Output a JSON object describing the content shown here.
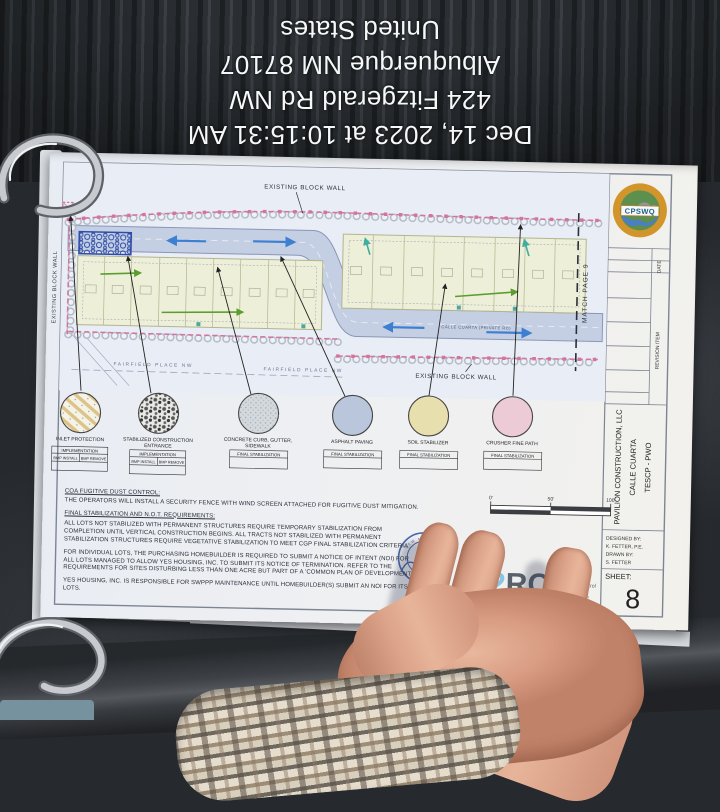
{
  "overlay": {
    "line1": "Dec 14, 2023 at 10:15:31 AM",
    "line2": "424 Fitzgerald Rd NW",
    "line3": "Albuquerque NM 87107",
    "line4": "United States"
  },
  "plan": {
    "wall_label_top": "EXISTING BLOCK WALL",
    "wall_label_bottom": "EXISTING BLOCK WALL",
    "wall_label_left": "EXISTING BLOCK WALL",
    "match_label": "MATCH PAGE 9",
    "street_label_1": "FAIRFIELD PLACE NW",
    "street_label_2": "FAIRFIELD PLACE NW",
    "road_label": "CALLE CUARTA (PRIVATE RD)"
  },
  "legend": {
    "items": [
      {
        "lines": [
          "INLET PROTECTION"
        ],
        "header": "IMPLEMENTATION",
        "col1": "BMP INSTALL",
        "col2": "BMP REMOVE"
      },
      {
        "lines": [
          "STABILIZED CONSTRUCTION",
          "ENTRANCE"
        ],
        "header": "IMPLEMENTATION",
        "col1": "BMP INSTALL",
        "col2": "BMP REMOVE"
      },
      {
        "lines": [
          "CONCRETE CURB, GUTTER,",
          "SIDEWALK"
        ],
        "header": "FINAL STABILIZATION"
      },
      {
        "lines": [
          "ASPHALT PAVING"
        ],
        "header": "FINAL STABILIZATION"
      },
      {
        "lines": [
          "SOIL STABILIZER"
        ],
        "header": "FINAL STABILIZATION"
      },
      {
        "lines": [
          "CRUSHER FINE PATH"
        ],
        "header": "FINAL STABILIZATION"
      }
    ]
  },
  "notes": {
    "h1": "COA FUGITIVE DUST CONTROL:",
    "p1": "THE OPERATORS WILL INSTALL A SECURITY FENCE WITH WIND SCREEN ATTACHED FOR FUGITIVE DUST MITIGATION.",
    "h2": "FINAL STABILIZATION AND N.O.T. REQUIREMENTS:",
    "p2": "ALL LOTS NOT STABILIZED WITH PERMANENT STRUCTURES REQUIRE TEMPORARY STABILIZATION FROM COMPLETION UNTIL VERTICAL CONSTRUCTION BEGINS. ALL TRACTS NOT STABILIZED WITH PERMANENT STABILIZATION STRUCTURES REQUIRE VEGETATIVE STABILIZATION TO MEET CGP FINAL STABILIZATION CRITERIA.",
    "p3": "FOR INDIVIDUAL LOTS, THE PURCHASING HOMEBUILDER IS REQUIRED TO SUBMIT A NOTICE OF INTENT (NOI) FOR ALL LOTS MANAGED TO ALLOW YES HOUSING, INC. TO SUBMIT ITS NOTICE OF TERMINATION. REFER TO THE REQUIREMENTS FOR SITES DISTURBING LESS THAN ONE ACRE BUT PART OF A 'COMMON PLAN OF DEVELOPMENT'.",
    "p4": "YES HOUSING, INC. IS RESPONSIBLE FOR SWPPP MAINTENANCE UNTIL HOMEBUILDER(S) SUBMIT AN NOI FOR ITS LOTS."
  },
  "scale": {
    "t0": "0'",
    "t50": "50'",
    "t100": "100'"
  },
  "firm": {
    "logo_e": "E",
    "logo_2": "2",
    "logo_rc": "RC",
    "stamp_state": "NEW MEXICO",
    "services": [
      "SWPPP",
      "Stormwater",
      "Erosion Control",
      "Reclamation",
      "Seeding"
    ],
    "contact": "m | 505.867.4040"
  },
  "title_block": {
    "cert": "CPSWQ",
    "date": "DATE",
    "revision": "REVISION ITEM",
    "project1": "PAVILION CONSTRUCTION, LLC",
    "project2": "CALLE CUARTA",
    "project3": "TESCP - PWO",
    "designed_label": "DESIGNED BY:",
    "designed": "K. FETTER, P.E.",
    "drawn_label": "DRAWN BY:",
    "drawn": "S. FETTER",
    "sheet_label": "SHEET:",
    "sheet": "8"
  },
  "colors": {
    "paper": "#eef0f4",
    "road": "#c4cfe3",
    "lots": "#edefd8",
    "silt_fence_pink": "#d4749a",
    "cert_ring_orange": "#d2952c",
    "stamp_blue": "#4b67ae",
    "logo_blue": "#84c7e6"
  }
}
